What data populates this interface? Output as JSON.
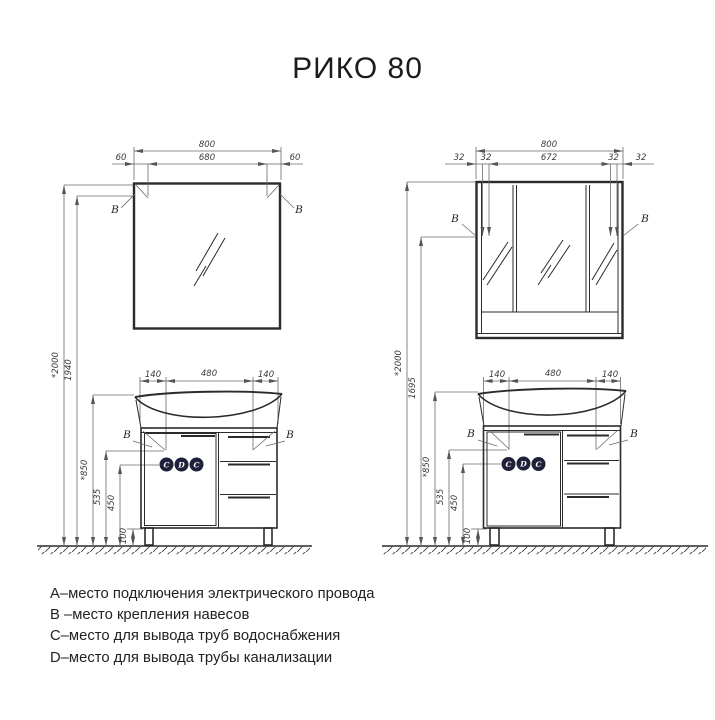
{
  "title": "РИКО 80",
  "views": {
    "left": {
      "width_total": "800",
      "width_segments": [
        "60",
        "680",
        "60"
      ],
      "heights": [
        "*2000",
        "1940",
        "*850",
        "535",
        "450",
        "100"
      ],
      "vanity_widths": [
        "140",
        "480",
        "140"
      ],
      "mount_label": "B",
      "ports": [
        "C",
        "D",
        "C"
      ]
    },
    "right": {
      "width_total": "800",
      "width_segments": [
        "32",
        "32",
        "672",
        "32",
        "32"
      ],
      "heights": [
        "*2000",
        "1695",
        "*850",
        "535",
        "450",
        "100"
      ],
      "vanity_widths": [
        "140",
        "480",
        "140"
      ],
      "mount_label": "B",
      "ports": [
        "C",
        "D",
        "C"
      ]
    }
  },
  "legend": {
    "items": [
      "А–место подключения электрического провода",
      "В –место крепления навесов",
      "С–место для вывода труб водоснабжения",
      "D–место для вывода трубы канализации"
    ]
  },
  "colors": {
    "ink": "#2b2b2b",
    "dim_line": "#6a6a6a",
    "port_badge": "#20203a",
    "port_text": "#ffffff"
  }
}
